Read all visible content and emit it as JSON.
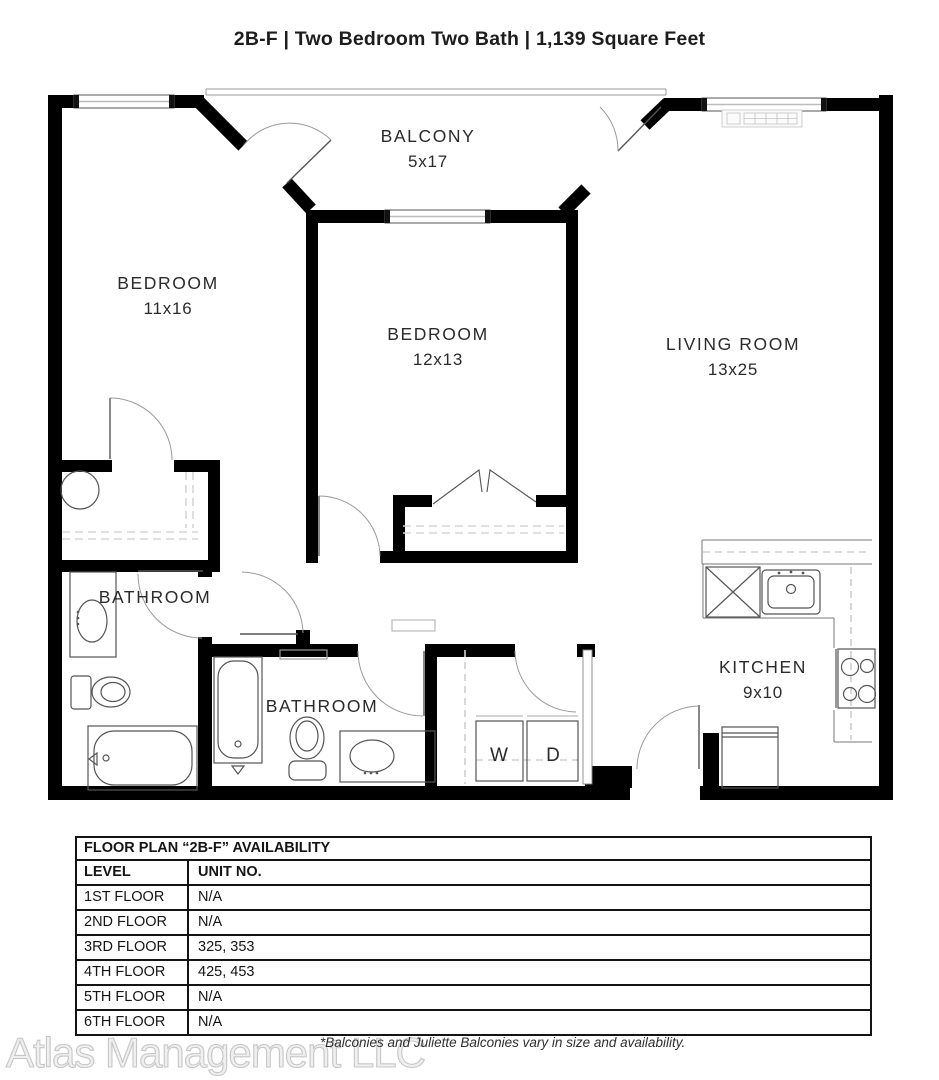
{
  "title": "2B-F | Two Bedroom Two Bath | 1,139 Square Feet",
  "plan": {
    "rooms": [
      {
        "name": "BALCONY",
        "dims": "5x17"
      },
      {
        "name": "BEDROOM",
        "dims": "11x16"
      },
      {
        "name": "BEDROOM",
        "dims": "12x13"
      },
      {
        "name": "LIVING ROOM",
        "dims": "13x25"
      },
      {
        "name": "BATHROOM",
        "dims": ""
      },
      {
        "name": "BATHROOM",
        "dims": ""
      },
      {
        "name": "KITCHEN",
        "dims": "9x10"
      }
    ],
    "washer_label": "W",
    "dryer_label": "D"
  },
  "table": {
    "title": "FLOOR PLAN “2B-F” AVAILABILITY",
    "headers": [
      "LEVEL",
      "UNIT NO."
    ],
    "rows": [
      {
        "level": "1ST FLOOR",
        "unit": "N/A"
      },
      {
        "level": "2ND FLOOR",
        "unit": "N/A"
      },
      {
        "level": "3RD FLOOR",
        "unit": "325, 353"
      },
      {
        "level": "4TH FLOOR",
        "unit": "425, 453"
      },
      {
        "level": "5TH FLOOR",
        "unit": "N/A"
      },
      {
        "level": "6TH FLOOR",
        "unit": "N/A"
      }
    ]
  },
  "footer": {
    "watermark": "Atlas Management LLC",
    "note": "*Balconies and Juliette Balconies vary in size and availability."
  },
  "colors": {
    "wall": "#000000",
    "fixture": "#555555",
    "dash": "#d6d6d6",
    "text": "#2b2b2b"
  }
}
